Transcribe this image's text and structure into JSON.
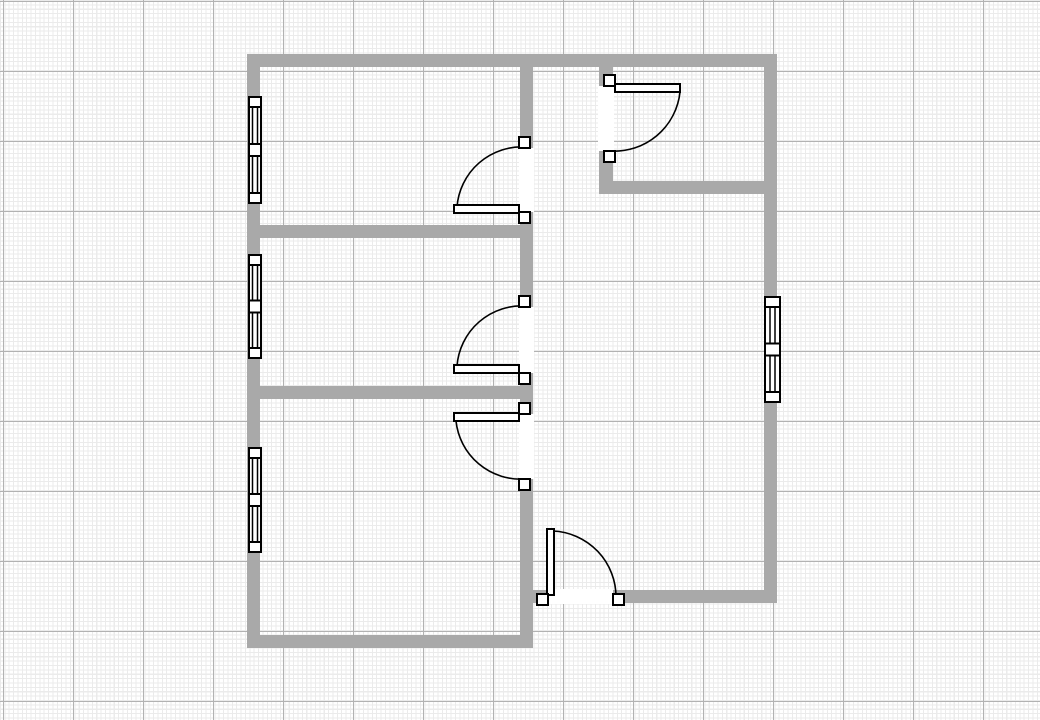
{
  "canvas": {
    "width": 1040,
    "height": 720,
    "background": "#ffffff",
    "grid": {
      "minor_spacing_px": 4.375,
      "minor_color": "#ebebeb",
      "major_spacing_px": 70,
      "major_color": "#b2b2b2",
      "major_offset_x": 3,
      "major_offset_y": 1
    }
  },
  "plan": {
    "wall_color": "#a9a9a9",
    "outline_color": "#000000",
    "symbol_fill": "#ffffff",
    "walls": [
      {
        "id": "wall-top",
        "x": 247,
        "y": 54,
        "w": 530,
        "h": 13
      },
      {
        "id": "wall-left",
        "x": 247,
        "y": 54,
        "w": 13,
        "h": 594
      },
      {
        "id": "wall-right",
        "x": 764,
        "y": 54,
        "w": 13,
        "h": 549
      },
      {
        "id": "wall-center-vertical",
        "x": 520,
        "y": 54,
        "w": 13,
        "h": 594
      },
      {
        "id": "wall-bottom-left",
        "x": 247,
        "y": 635,
        "w": 286,
        "h": 13
      },
      {
        "id": "wall-bottom-right",
        "x": 520,
        "y": 590,
        "w": 257,
        "h": 13
      },
      {
        "id": "wall-divider-upper",
        "x": 247,
        "y": 225,
        "w": 286,
        "h": 13
      },
      {
        "id": "wall-divider-lower",
        "x": 247,
        "y": 386,
        "w": 286,
        "h": 13
      },
      {
        "id": "wall-entry-vertical",
        "x": 599,
        "y": 54,
        "w": 14,
        "h": 128
      },
      {
        "id": "wall-entry-horizontal",
        "x": 599,
        "y": 181,
        "w": 178,
        "h": 13
      }
    ],
    "doors": [
      {
        "id": "door-hall-upper",
        "gap": {
          "x": 519,
          "y": 148,
          "w": 15,
          "h": 64
        },
        "jambs": [
          {
            "x": 519,
            "y": 137,
            "w": 11,
            "h": 11
          },
          {
            "x": 519,
            "y": 212,
            "w": 11,
            "h": 11
          }
        ],
        "leaf": {
          "x": 454,
          "y": 205,
          "w": 65,
          "h": 8
        },
        "arc": {
          "x1": 526,
          "y1": 147,
          "x2": 457,
          "y2": 207,
          "r": 65,
          "sweep": 0
        }
      },
      {
        "id": "door-hall-middle",
        "gap": {
          "x": 519,
          "y": 307,
          "w": 15,
          "h": 66
        },
        "jambs": [
          {
            "x": 519,
            "y": 296,
            "w": 11,
            "h": 11
          },
          {
            "x": 519,
            "y": 373,
            "w": 11,
            "h": 11
          }
        ],
        "leaf": {
          "x": 454,
          "y": 365,
          "w": 65,
          "h": 8
        },
        "arc": {
          "x1": 526,
          "y1": 306,
          "x2": 457,
          "y2": 366,
          "r": 65,
          "sweep": 0
        }
      },
      {
        "id": "door-hall-lower",
        "gap": {
          "x": 519,
          "y": 414,
          "w": 15,
          "h": 65
        },
        "jambs": [
          {
            "x": 519,
            "y": 403,
            "w": 11,
            "h": 11
          },
          {
            "x": 519,
            "y": 479,
            "w": 11,
            "h": 11
          }
        ],
        "leaf": {
          "x": 454,
          "y": 413,
          "w": 65,
          "h": 8
        },
        "arc": {
          "x1": 456,
          "y1": 421,
          "x2": 525,
          "y2": 479,
          "r": 65,
          "sweep": 0
        }
      },
      {
        "id": "door-entry",
        "gap": {
          "x": 598,
          "y": 86,
          "w": 16,
          "h": 65
        },
        "jambs": [
          {
            "x": 604,
            "y": 75,
            "w": 11,
            "h": 11
          },
          {
            "x": 604,
            "y": 151,
            "w": 11,
            "h": 11
          }
        ],
        "leaf": {
          "x": 615,
          "y": 84,
          "w": 65,
          "h": 8
        },
        "arc": {
          "x1": 680,
          "y1": 92,
          "x2": 610,
          "y2": 151,
          "r": 66,
          "sweep": 1
        }
      },
      {
        "id": "door-exterior-bottom",
        "gap": {
          "x": 548,
          "y": 589,
          "w": 65,
          "h": 15
        },
        "jambs": [
          {
            "x": 537,
            "y": 594,
            "w": 11,
            "h": 11
          },
          {
            "x": 613,
            "y": 594,
            "w": 11,
            "h": 11
          }
        ],
        "leaf": {
          "x": 547,
          "y": 529,
          "w": 7,
          "h": 66
        },
        "arc": {
          "x1": 553,
          "y1": 531,
          "x2": 616,
          "y2": 597,
          "r": 66,
          "sweep": 1
        }
      }
    ],
    "windows": [
      {
        "id": "window-left-upper",
        "x": 249,
        "y": 97,
        "w": 12,
        "h": 106,
        "orientation": "vertical"
      },
      {
        "id": "window-left-middle",
        "x": 249,
        "y": 255,
        "w": 12,
        "h": 103,
        "orientation": "vertical"
      },
      {
        "id": "window-left-lower",
        "x": 249,
        "y": 448,
        "w": 12,
        "h": 104,
        "orientation": "vertical"
      },
      {
        "id": "window-right",
        "x": 765,
        "y": 297,
        "w": 15,
        "h": 105,
        "orientation": "vertical"
      }
    ]
  }
}
